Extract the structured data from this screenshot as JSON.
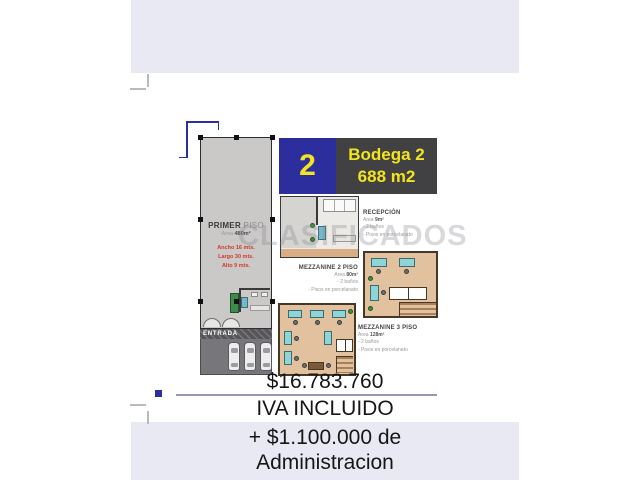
{
  "banner": {
    "number": "2",
    "title": "Bodega 2",
    "area": "688 m2"
  },
  "primer_piso": {
    "title_bold": "PRIMER",
    "title_rest": " PISO",
    "area_label": "Area ",
    "area_value": "480m²",
    "dimensions": [
      "Ancho 16 mts.",
      "Largo 30 mts.",
      "Alto 9 mts."
    ],
    "entrada": "ENTRADA"
  },
  "recepcion": {
    "title": "RECEPCIÓN",
    "area_label": "Area ",
    "area_value": "9m²",
    "features": [
      "- 2 baños",
      "- Pisos en porcelanato"
    ]
  },
  "mezzanine2": {
    "title": "MEZZANINE 2 PISO",
    "area_label": "Area ",
    "area_value": "80m²",
    "features": [
      "- 2 baños",
      "- Pisos en porcelanato"
    ]
  },
  "mezzanine3": {
    "title": "MEZZANINE 3 PISO",
    "area_label": "Area ",
    "area_value": "128m²",
    "features": [
      "- 2 baños",
      "- Pisos en porcelanato"
    ]
  },
  "watermark": "CLASIFICADOS",
  "pricing": {
    "price": "$16.783.760",
    "tax_note": "IVA INCLUIDO",
    "admin_line1": "+ $1.100.000 de",
    "admin_line2": "Administracion"
  },
  "colors": {
    "banner_blue": "#2c2e9e",
    "banner_dark": "#414043",
    "accent_yellow": "#f2e41e",
    "lavender": "#e9e9f3",
    "dimension_red": "#d3392c",
    "plan_gray": "#cac9c7",
    "floor_tan": "#e2c19e"
  }
}
